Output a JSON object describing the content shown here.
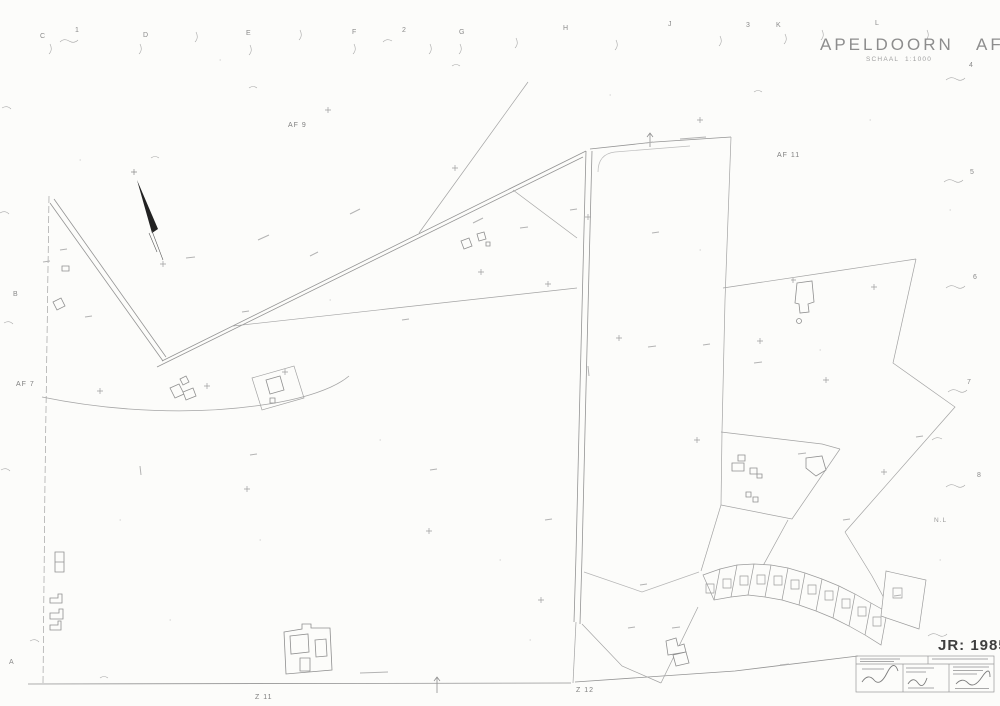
{
  "sheet": {
    "municipality_title": "APELDOORN   AF 6",
    "scale_note": "SCHAAL  1:1000",
    "year_stamp": "JR: 1985"
  },
  "neighbor_sheets": {
    "top_center": "AF 9",
    "top_right": "AF 11",
    "left": "AF 7",
    "bottom_left": "Z 11",
    "bottom_center": "Z 12",
    "right_outside": "N.L"
  },
  "edge_refs": {
    "top": [
      "C",
      "1",
      "D",
      "E",
      "F",
      "2",
      "G",
      "H",
      "J",
      "3",
      "K",
      "L"
    ],
    "right": [
      "4",
      "5",
      "6",
      "7",
      "8"
    ],
    "left": [
      "B",
      "A"
    ]
  },
  "colors": {
    "linework": "#9a9a9a",
    "faint_line": "#b3b3b3",
    "ink_mark": "#222222",
    "label_gray": "#828282"
  }
}
